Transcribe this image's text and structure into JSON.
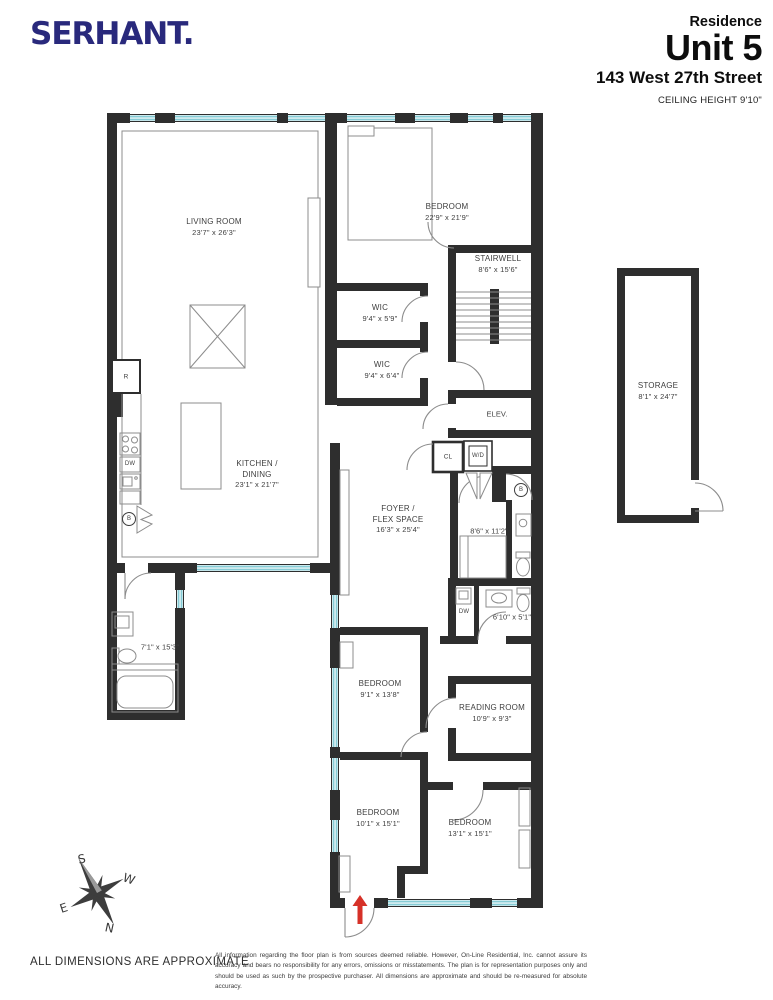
{
  "header": {
    "brand": "SERHANT.",
    "residence_label": "Residence",
    "unit": "Unit 5",
    "address": "143 West 27th Street",
    "ceiling_height": "CEILING HEIGHT 9'10\""
  },
  "rooms": {
    "living_room": {
      "lines": [
        "LIVING ROOM",
        "23'7\" x 26'3\""
      ]
    },
    "bedroom_top": {
      "lines": [
        "BEDROOM",
        "22'9\" x 21'9\""
      ]
    },
    "stairwell": {
      "lines": [
        "STAIRWELL",
        "8'6\" x 15'6\""
      ]
    },
    "wic_upper": {
      "lines": [
        "WIC",
        "9'4\" x 5'9\""
      ]
    },
    "wic_lower": {
      "lines": [
        "WIC",
        "9'4\" x 6'4\""
      ]
    },
    "elevator": {
      "label": "ELEV."
    },
    "storage": {
      "lines": [
        "STORAGE",
        "8'1\" x 24'7\""
      ]
    },
    "kitchen": {
      "lines": [
        "KITCHEN /",
        "DINING",
        "23'1\" x 21'7\""
      ]
    },
    "foyer": {
      "lines": [
        "FOYER /",
        "FLEX SPACE",
        "16'3\" x 25'4\""
      ]
    },
    "closet": {
      "label": "CL"
    },
    "washer_dryer": {
      "label": "W/D"
    },
    "office": {
      "dims": "8'6\" x 11'2\""
    },
    "bath_small": {
      "dims": "6'10\" x 5'1\""
    },
    "bath_left": {
      "dims": "7'1\" x 15'3\""
    },
    "bedroom_mid": {
      "lines": [
        "BEDROOM",
        "9'1\" x 13'8\""
      ]
    },
    "reading_room": {
      "lines": [
        "READING ROOM",
        "10'9\" x 9'3\""
      ]
    },
    "bedroom_bottom_left": {
      "lines": [
        "BEDROOM",
        "10'1\" x 15'1\""
      ]
    },
    "bedroom_bottom_right": {
      "lines": [
        "BEDROOM",
        "13'1\" x 15'1\""
      ]
    },
    "fridge": {
      "label": "R"
    },
    "dishwasher": {
      "label": "DW"
    },
    "dishwasher2": {
      "label": "DW"
    },
    "bath_circle_kitchen": {
      "label": "B"
    },
    "bath_circle_ensuite": {
      "label": "B"
    }
  },
  "compass": {
    "n": "N",
    "s": "S",
    "e": "E",
    "w": "W"
  },
  "footer": {
    "dimensions_note": "ALL DIMENSIONS ARE APPROXIMATE",
    "disclaimer": "All information regarding the floor plan is from sources deemed reliable. However, On-Line Residential, Inc. cannot assure its accuracy and bears no responsibility for any errors, omissions or misstatements. The plan is for representation purposes only and should be used as such by the prospective purchaser. All dimensions are approximate and should be re-measured for absolute accuracy."
  },
  "colors": {
    "brand": "#29297c",
    "wall": "#2e2e2e",
    "window": "#85cbd5",
    "arrow": "#d63128",
    "line": "#8c8c8c"
  }
}
